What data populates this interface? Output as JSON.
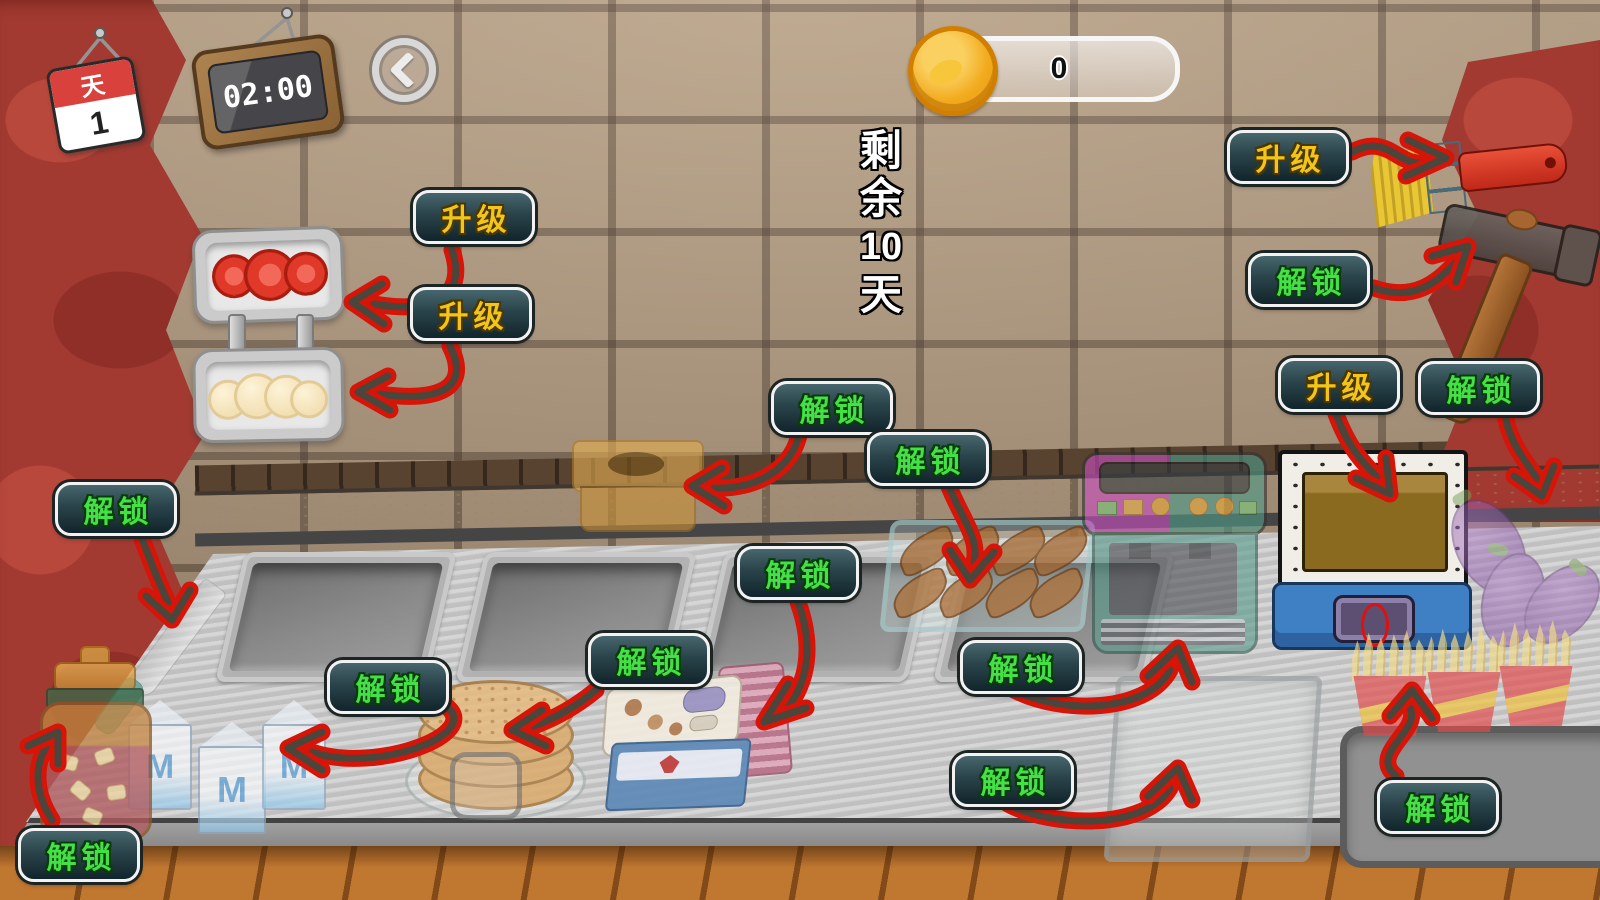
{
  "hud": {
    "day_label": "天",
    "day_number": "1",
    "timer": "02:00",
    "coin_count": "0",
    "days_remaining": [
      "剩",
      "余",
      "10",
      "天"
    ]
  },
  "items": {
    "milk_logo": "M"
  },
  "colors": {
    "button_upgrade_text": "#f2c51d",
    "button_unlock_text": "#45e045",
    "button_face_top": "#47666d",
    "button_face_bottom": "#11252b",
    "arrow_red": "#d61408",
    "coin_gold": "#f2ab1d",
    "curtain_red": "#a23a31",
    "wall_tile": "#b59c80",
    "calendar_red": "#d9413d"
  },
  "actions": [
    {
      "id": "upgrade-tomato-tray",
      "label": "升级"
    },
    {
      "id": "upgrade-bun-tray",
      "label": "升级"
    },
    {
      "id": "upgrade-paintbrush",
      "label": "升级"
    },
    {
      "id": "unlock-hammer",
      "label": "解锁"
    },
    {
      "id": "unlock-butter-box",
      "label": "解锁"
    },
    {
      "id": "unlock-chicken",
      "label": "解锁"
    },
    {
      "id": "upgrade-fryer",
      "label": "升级"
    },
    {
      "id": "unlock-eggplant",
      "label": "解锁"
    },
    {
      "id": "unlock-knife",
      "label": "解锁"
    },
    {
      "id": "unlock-steamer-box",
      "label": "解锁"
    },
    {
      "id": "unlock-pancakes",
      "label": "解锁"
    },
    {
      "id": "unlock-milk",
      "label": "解锁"
    },
    {
      "id": "unlock-coffee-machine",
      "label": "解锁"
    },
    {
      "id": "unlock-glass-bin",
      "label": "解锁"
    },
    {
      "id": "unlock-sauce-jar",
      "label": "解锁"
    },
    {
      "id": "unlock-fries",
      "label": "解锁"
    }
  ]
}
